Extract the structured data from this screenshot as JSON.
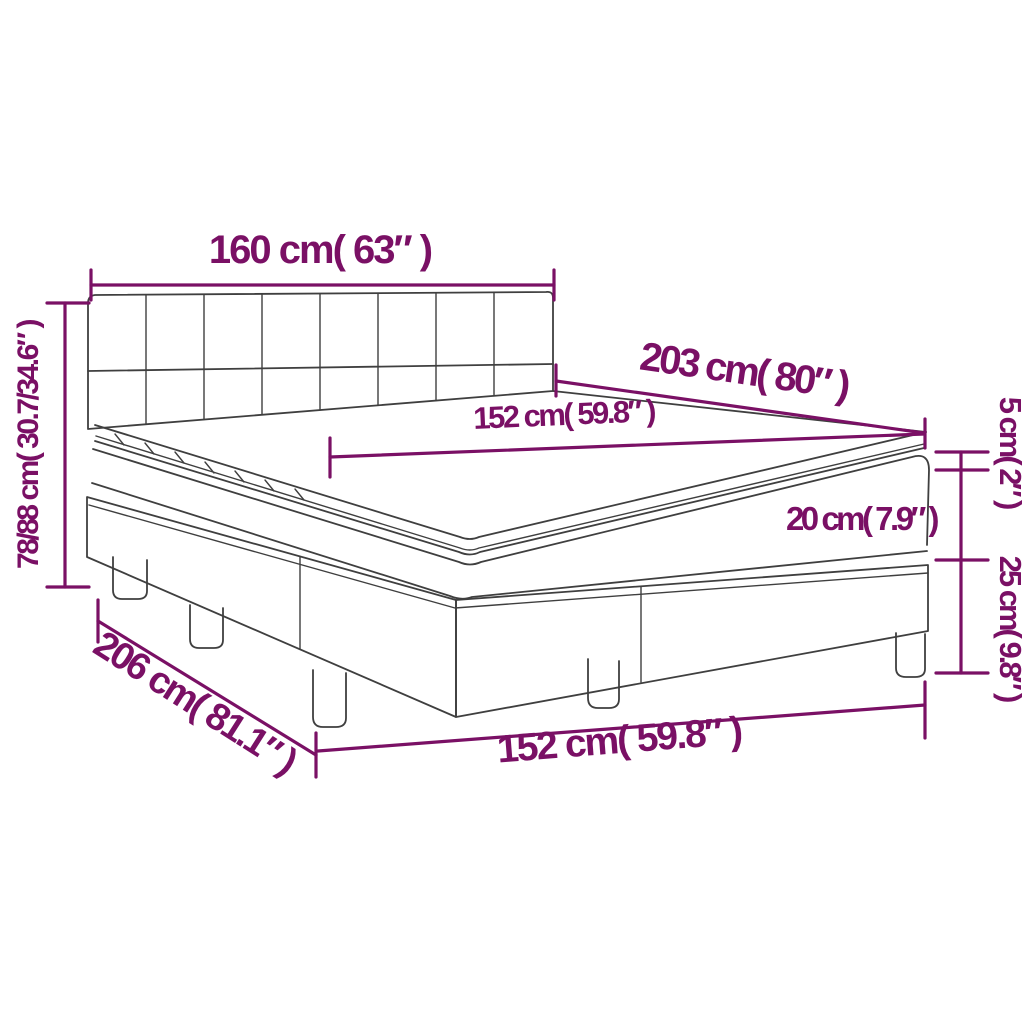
{
  "diagram": {
    "subject": "Box spring bed with headboard, mattress and topper — dimension diagram",
    "colors": {
      "dimension_color": "#7a1065",
      "linework_color": "#3f3f3f",
      "background": "#ffffff"
    },
    "structure": {
      "headboard_grid_columns": 8,
      "headboard_grid_rows": 2,
      "legs_visible": 5
    },
    "labels": {
      "headboard_width": "160 cm( 63″ )",
      "bed_height": "78/88 cm( 30.7/34.6″ )",
      "bed_length": "203 cm( 80″ )",
      "mattress_width": "152 cm( 59.8″ )",
      "topper_thickness": "5 cm( 2″ )",
      "mattress_thickness": "20 cm( 7.9″ )",
      "base_height": "25 cm( 9.8″ )",
      "base_length": "206 cm( 81.1″ )",
      "base_width": "152 cm( 59.8″ )"
    }
  }
}
